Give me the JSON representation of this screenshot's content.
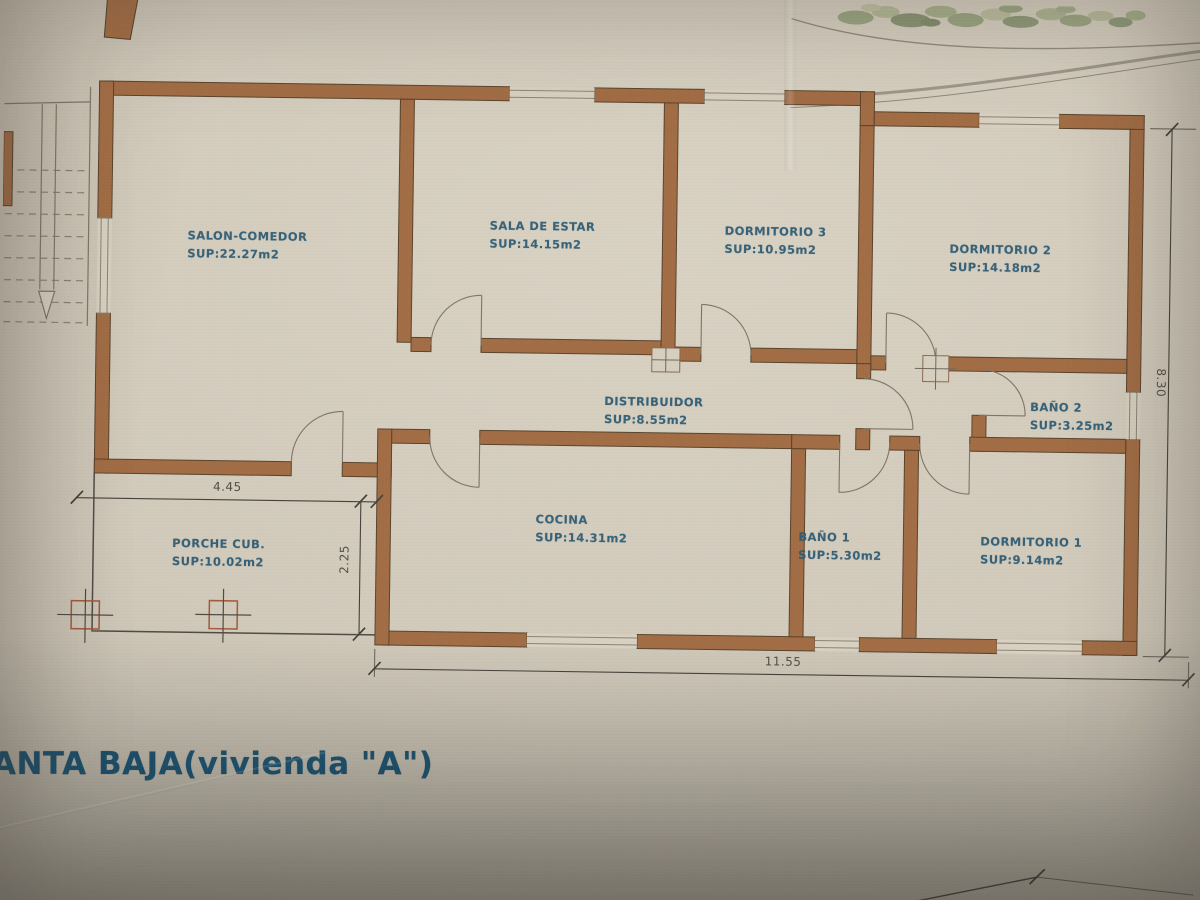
{
  "document": {
    "type": "architectural floor plan photo",
    "title": "ANTA BAJA(vivienda \"A\")"
  },
  "rooms": [
    {
      "name": "SALON-COMEDOR",
      "area": "SUP:22.27m2"
    },
    {
      "name": "SALA DE ESTAR",
      "area": "SUP:14.15m2"
    },
    {
      "name": "DORMITORIO 3",
      "area": "SUP:10.95m2"
    },
    {
      "name": "DORMITORIO 2",
      "area": "SUP:14.18m2"
    },
    {
      "name": "DISTRIBUIDOR",
      "area": "SUP:8.55m2"
    },
    {
      "name": "BAÑO 2",
      "area": "SUP:3.25m2"
    },
    {
      "name": "COCINA",
      "area": "SUP:14.31m2"
    },
    {
      "name": "BAÑO 1",
      "area": "SUP:5.30m2"
    },
    {
      "name": "DORMITORIO 1",
      "area": "SUP:9.14m2"
    },
    {
      "name": "PORCHE CUB.",
      "area": "SUP:10.02m2"
    }
  ],
  "dimensions": {
    "porch_width": "4.45",
    "porch_depth": "2.25",
    "building_width": "11.55",
    "building_depth": "8.30"
  },
  "colors": {
    "paper": "#d1cabb",
    "wall_fill": "#a26d45",
    "wall_outline": "#5a442c",
    "room_label_text": "#2c5a73",
    "title_text": "#1d4e68",
    "dimension_text": "#45423b"
  }
}
